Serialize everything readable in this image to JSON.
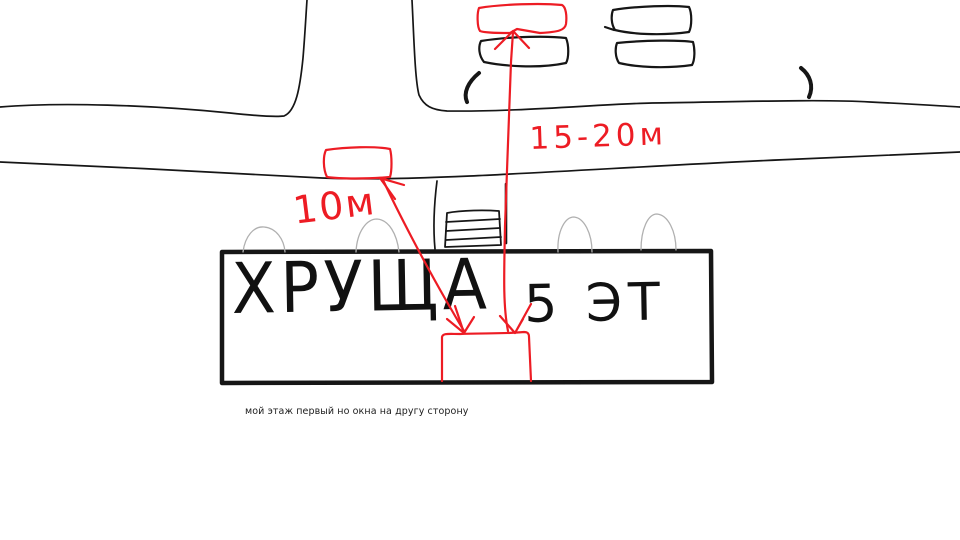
{
  "labels": {
    "building_name": "ХРУЩА",
    "building_floors": "5 ЭТ",
    "distance_short": "10м",
    "distance_long": "15-20м",
    "note": "мой этаж первый но окна на другу сторону"
  },
  "colors": {
    "ink": "#161616",
    "red": "#ed1c24",
    "tree_gray": "#b0b0b0"
  }
}
